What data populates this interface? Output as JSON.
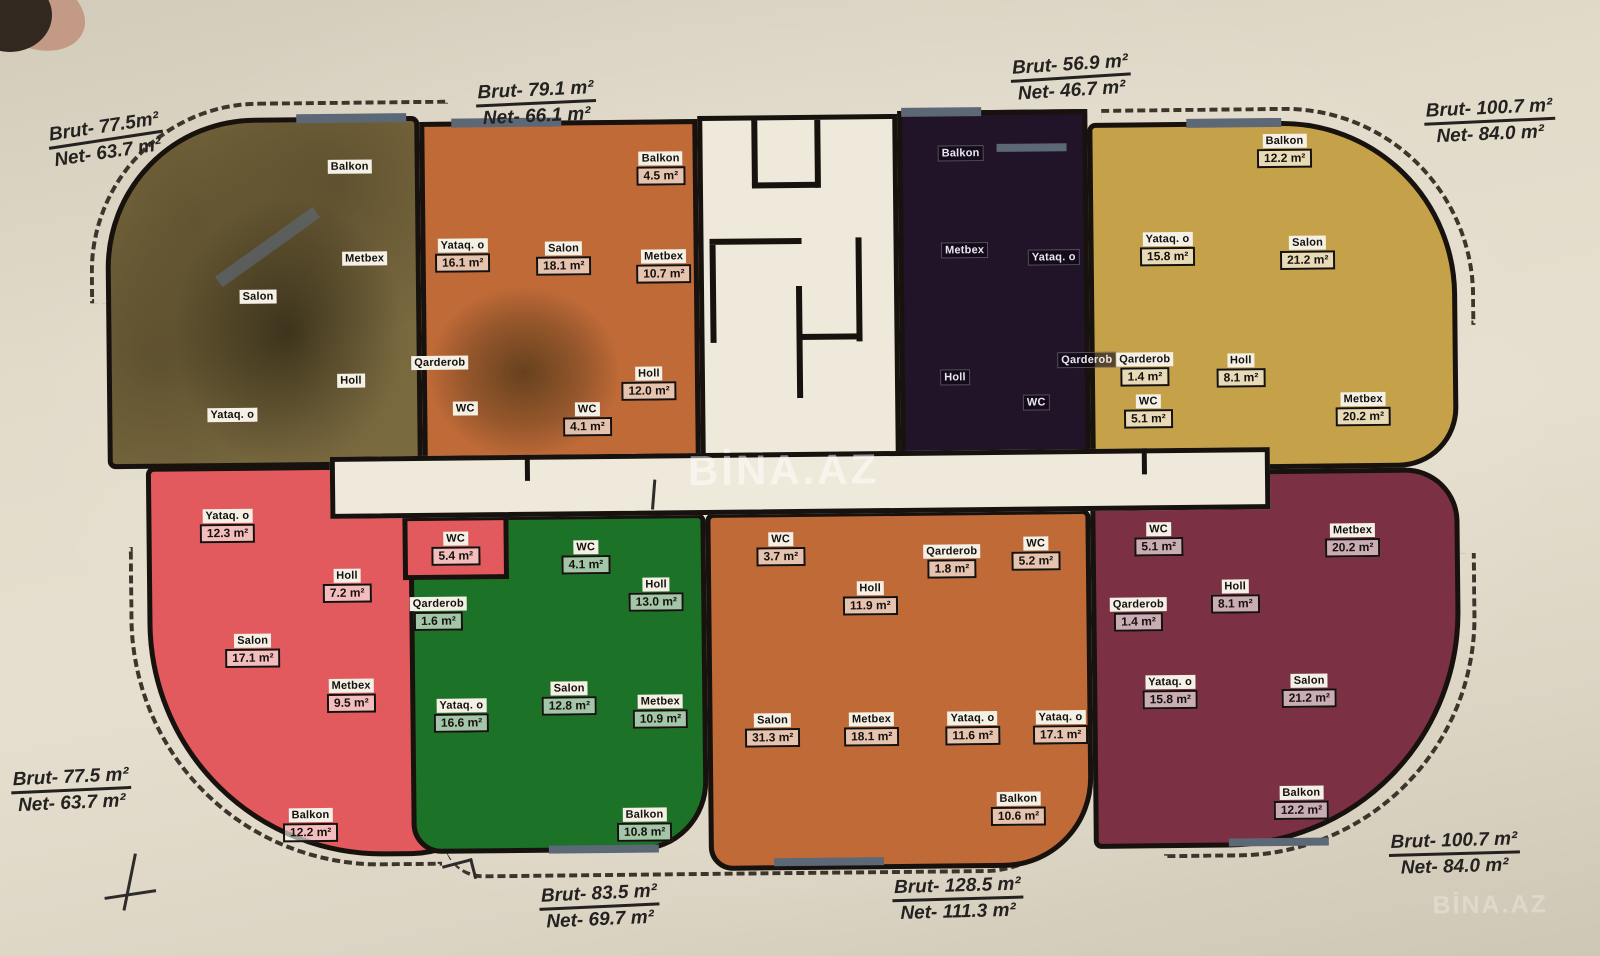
{
  "watermark": {
    "center": "BİNA.AZ",
    "corner": "BİNA.AZ"
  },
  "colors": {
    "paper": "#e2dbca",
    "walls": "#17120e",
    "core_white": "#efe9db",
    "window_gray": "#5d6877"
  },
  "apartments": [
    {
      "id": "top-left",
      "color": "#79693f",
      "label": {
        "brut": "Brut- 77.5m²",
        "net": "Net- 63.7 m²"
      },
      "rooms": [
        {
          "name": "Balkon",
          "area": ""
        },
        {
          "name": "Metbex",
          "area": ""
        },
        {
          "name": "Salon",
          "area": ""
        },
        {
          "name": "Holl",
          "area": ""
        },
        {
          "name": "Yataq. o",
          "area": ""
        }
      ]
    },
    {
      "id": "top-second",
      "color": "#c06a38",
      "label": {
        "brut": "Brut- 79.1 m²",
        "net": "Net- 66.1 m²"
      },
      "rooms": [
        {
          "name": "Balkon",
          "area": "4.5 m²"
        },
        {
          "name": "Yataq. o",
          "area": "16.1 m²"
        },
        {
          "name": "Salon",
          "area": "18.1 m²"
        },
        {
          "name": "Metbex",
          "area": "10.7 m²"
        },
        {
          "name": "Qarderob",
          "area": ""
        },
        {
          "name": "Holl",
          "area": "12.0 m²"
        },
        {
          "name": "WC",
          "area": ""
        },
        {
          "name": "WC",
          "area": "4.1 m²"
        }
      ]
    },
    {
      "id": "top-third",
      "color": "#211328",
      "label": {
        "brut": "Brut- 56.9 m²",
        "net": "Net- 46.7 m²"
      },
      "rooms": [
        {
          "name": "Balkon",
          "area": ""
        },
        {
          "name": "Metbex",
          "area": ""
        },
        {
          "name": "Yataq. o",
          "area": ""
        },
        {
          "name": "Qarderob",
          "area": ""
        },
        {
          "name": "Holl",
          "area": ""
        },
        {
          "name": "WC",
          "area": ""
        }
      ]
    },
    {
      "id": "top-right",
      "color": "#c5a24a",
      "label": {
        "brut": "Brut- 100.7 m²",
        "net": "Net- 84.0 m²"
      },
      "rooms": [
        {
          "name": "Balkon",
          "area": "12.2 m²"
        },
        {
          "name": "Yataq. o",
          "area": "15.8 m²"
        },
        {
          "name": "Salon",
          "area": "21.2 m²"
        },
        {
          "name": "Qarderob",
          "area": "1.4 m²"
        },
        {
          "name": "Holl",
          "area": "8.1 m²"
        },
        {
          "name": "WC",
          "area": "5.1 m²"
        },
        {
          "name": "Metbex",
          "area": "20.2 m²"
        }
      ]
    },
    {
      "id": "bottom-left",
      "color": "#e25a5e",
      "label": {
        "brut": "Brut- 77.5 m²",
        "net": "Net- 63.7 m²"
      },
      "rooms": [
        {
          "name": "Yataq. o",
          "area": "12.3 m²"
        },
        {
          "name": "WC",
          "area": "5.4 m²"
        },
        {
          "name": "Holl",
          "area": "7.2 m²"
        },
        {
          "name": "Salon",
          "area": "17.1 m²"
        },
        {
          "name": "Metbex",
          "area": "9.5 m²"
        },
        {
          "name": "Balkon",
          "area": "12.2 m²"
        }
      ]
    },
    {
      "id": "bottom-second",
      "color": "#1c7226",
      "label": {
        "brut": "Brut- 83.5 m²",
        "net": "Net- 69.7 m²"
      },
      "rooms": [
        {
          "name": "WC",
          "area": "4.1 m²"
        },
        {
          "name": "Holl",
          "area": "13.0 m²"
        },
        {
          "name": "Qarderob",
          "area": "1.6 m²"
        },
        {
          "name": "Yataq. o",
          "area": "16.6 m²"
        },
        {
          "name": "Salon",
          "area": "12.8 m²"
        },
        {
          "name": "Metbex",
          "area": "10.9 m²"
        },
        {
          "name": "Balkon",
          "area": "10.8 m²"
        }
      ]
    },
    {
      "id": "bottom-third",
      "color": "#c06a38",
      "label": {
        "brut": "Brut- 128.5 m²",
        "net": "Net- 111.3 m²"
      },
      "rooms": [
        {
          "name": "WC",
          "area": "3.7 m²"
        },
        {
          "name": "Qarderob",
          "area": "1.8 m²"
        },
        {
          "name": "WC",
          "area": "5.2 m²"
        },
        {
          "name": "Holl",
          "area": "11.9 m²"
        },
        {
          "name": "Salon",
          "area": "31.3 m²"
        },
        {
          "name": "Metbex",
          "area": "18.1 m²"
        },
        {
          "name": "Yataq. o",
          "area": "11.6 m²"
        },
        {
          "name": "Yataq. o",
          "area": "17.1 m²"
        },
        {
          "name": "Balkon",
          "area": "10.6 m²"
        }
      ]
    },
    {
      "id": "bottom-right",
      "color": "#7b3044",
      "label": {
        "brut": "Brut- 100.7 m²",
        "net": "Net- 84.0 m²"
      },
      "rooms": [
        {
          "name": "WC",
          "area": "5.1 m²"
        },
        {
          "name": "Metbex",
          "area": "20.2 m²"
        },
        {
          "name": "Holl",
          "area": "8.1 m²"
        },
        {
          "name": "Qarderob",
          "area": "1.4 m²"
        },
        {
          "name": "Yataq. o",
          "area": "15.8 m²"
        },
        {
          "name": "Salon",
          "area": "21.2 m²"
        },
        {
          "name": "Balkon",
          "area": "12.2 m²"
        }
      ]
    }
  ]
}
